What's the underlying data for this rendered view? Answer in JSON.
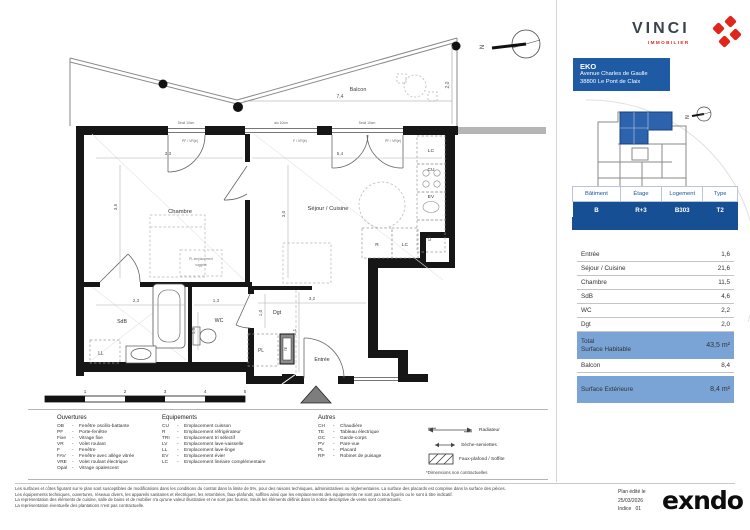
{
  "brand": {
    "wordmark": "VINCI",
    "subtitle": "IMMOBILIER"
  },
  "project": {
    "name": "EKO",
    "address_line1": "Avenue Charles de Gaulle",
    "address_line2": "38800 Le Pont de Claix"
  },
  "unit_table": {
    "headers": [
      "Bâtiment",
      "Étage",
      "Logement",
      "Type"
    ],
    "values": [
      "B",
      "R+3",
      "B303",
      "T2"
    ]
  },
  "surface_table": {
    "rows": [
      {
        "label": "Entrée",
        "value": "1,6"
      },
      {
        "label": "Séjour / Cuisine",
        "value": "21,6"
      },
      {
        "label": "Chambre",
        "value": "11,5"
      },
      {
        "label": "SdB",
        "value": "4,6"
      },
      {
        "label": "WC",
        "value": "2,2"
      },
      {
        "label": "Dgt",
        "value": "2,0"
      }
    ],
    "total_label_line1": "Total",
    "total_label_line2": "Surface Habitable",
    "total_value": "43,5 m²",
    "balcon_label": "Balcon",
    "balcon_value": "8,4",
    "exterior_label": "Surface Extérieure",
    "exterior_value": "8,4 m²"
  },
  "plan": {
    "rooms": {
      "chambre": "Chambre",
      "sejour": "Séjour / Cuisine",
      "sdb": "SdB",
      "wc": "WC",
      "dgt": "Dgt",
      "entree": "Entrée",
      "balcon": "Balcon"
    },
    "dims": {
      "d33": "3,3",
      "d35": "3,5",
      "d54": "5,4",
      "d30": "3,0",
      "d23": "2,3",
      "d13": "1,3",
      "d15": "1,5",
      "d10": "1,0",
      "d32": "3,2",
      "d21": "2,1",
      "d74": "7,4",
      "d20": "2,0"
    },
    "window_sills": [
      "Seuil 10cm",
      "alu 10cm",
      "Seuil 10cm"
    ],
    "window_types": [
      "PF / VR(é)",
      "F / VR(é)",
      "PF / VR(é)"
    ],
    "kitchen": [
      "LC",
      "CU",
      "EV",
      "LV",
      "R",
      "LC"
    ],
    "misc": {
      "ll": "LL",
      "pl": "PL",
      "te": "TE",
      "pl_sugg_1": "PL  emplacement",
      "pl_sugg_2": "suggéré",
      "north": "N"
    },
    "scale_ticks": [
      "1",
      "2",
      "3",
      "4",
      "5"
    ]
  },
  "legend": {
    "ouvertures": {
      "title": "Ouvertures",
      "items": [
        {
          "abbr": "OB",
          "label": "Fenêtre oscillo-battante"
        },
        {
          "abbr": "PF",
          "label": "Porte-fenêtre"
        },
        {
          "abbr": "Fixe",
          "label": "Vitrage fixe"
        },
        {
          "abbr": "VR",
          "label": "Volet roulant"
        },
        {
          "abbr": "F",
          "label": "Fenêtre"
        },
        {
          "abbr": "FAV",
          "label": "Fenêtre avec allège vitrée"
        },
        {
          "abbr": "VRE",
          "label": "Volet roulant électrique"
        },
        {
          "abbr": "Opal",
          "label": "Vitrage opalescent"
        }
      ]
    },
    "equipements": {
      "title": "Equipements",
      "items": [
        {
          "abbr": "CU",
          "label": "Emplacement cuisson"
        },
        {
          "abbr": "R",
          "label": "Emplacement réfrigérateur"
        },
        {
          "abbr": "TRI",
          "label": "Emplacement tri sélectif"
        },
        {
          "abbr": "LV",
          "label": "Emplacement lave-vaisselle"
        },
        {
          "abbr": "LL",
          "label": "Emplacement lave-linge"
        },
        {
          "abbr": "EV",
          "label": "Emplacement évier"
        },
        {
          "abbr": "LC",
          "label": "Emplacement linéaire complémentaire"
        }
      ]
    },
    "autres": {
      "title": "Autres",
      "items": [
        {
          "abbr": "CH",
          "label": "Chaudière"
        },
        {
          "abbr": "TE",
          "label": "Tableau électrique"
        },
        {
          "abbr": "GC",
          "label": "Garde-corps"
        },
        {
          "abbr": "PV",
          "label": "Pare-vue"
        },
        {
          "abbr": "PL",
          "label": "Placard"
        },
        {
          "abbr": "RP",
          "label": "Robinet de puisage"
        }
      ]
    },
    "symbols": [
      {
        "label": "Radiateur"
      },
      {
        "label": "Sèche-serviettes"
      },
      {
        "label": "Faux-plafond / Soffite"
      }
    ],
    "note": "*Dimensions non contractuelles"
  },
  "footer": {
    "legal_lines": [
      "Les surfaces et côtes figurant sur le plan sont susceptibles de modifications dans les conditions du contrat dans la limite de 5%, pour des raisons techniques, administratives ou réglementaires. La surface des placards est comprise dans la surface des pièces.",
      "Les équipements techniques, ouvertures, réseaux divers, les appareils sanitaires et électriques, les retombées, faux-plafonds, soffites ainsi que les emplacements des équipements ne sont pas tous figurés ou le sont à titre indicatif.",
      "La représentation des éléments de cuisine, salle de bains et de mobilier n'a qu'une valeur illustrative et ne sont pas fournis. Seuls les éléments définis dans la notice descriptive de vente sont contractuels.",
      "La représentation éventuelle des plantations n'est pas contractuelle."
    ],
    "edited_label": "Plan édité le",
    "edited_date": "25/03/2026",
    "index_label": "Indice",
    "index_value": "01",
    "logo": "exndo"
  },
  "colors": {
    "brand_blue": "#164f94",
    "box_blue": "#1f5aa5",
    "light_blue": "#7aa4d6",
    "vinci_red": "#e1251b"
  }
}
